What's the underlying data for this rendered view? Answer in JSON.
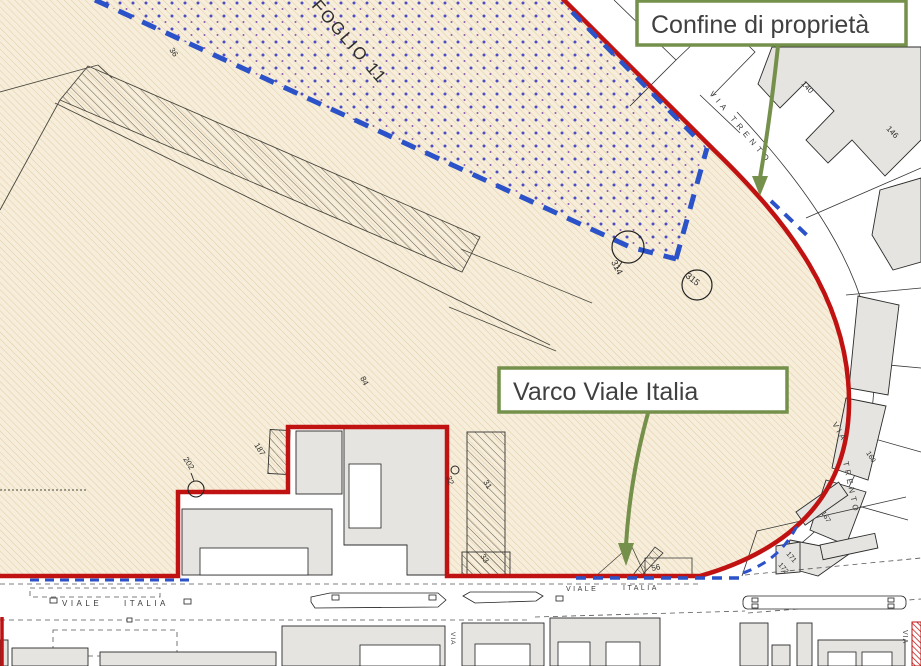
{
  "annotations": {
    "confine_di_proprieta": "Confine di proprietà",
    "varco_viale_italia": "Varco Viale Italia"
  },
  "streets": {
    "via_trento_upper": "VIA TRENTO",
    "via_trento_right_via": "VIA",
    "via_trento_right_trento": "TRENTO",
    "viale_italia_left_viale": "VIALE",
    "viale_italia_left_italia": "ITALIA",
    "viale_italia_mid_viale": "VIALE",
    "viale_italia_mid_italia": "ITALIA",
    "via_center": "VIA",
    "via_right": "VIA"
  },
  "labels": {
    "foglio": "FOGLIO 11",
    "p36": "36",
    "p314": "314",
    "p315": "315",
    "p84": "84",
    "p187": "187",
    "p202": "202",
    "p32": "32",
    "p31": "31",
    "p33": "33",
    "p56": "56",
    "p107": "107",
    "p140": "140",
    "p146": "146",
    "p171": "171",
    "p172": "172",
    "p160": "160",
    "p167": "167"
  },
  "colors": {
    "boundary_red": "#c11212",
    "boundary_blue": "#2b52c8",
    "annotation_green": "#74904a",
    "parcel_beige": "#f6eeda",
    "building_gray": "#e5e4e0"
  }
}
